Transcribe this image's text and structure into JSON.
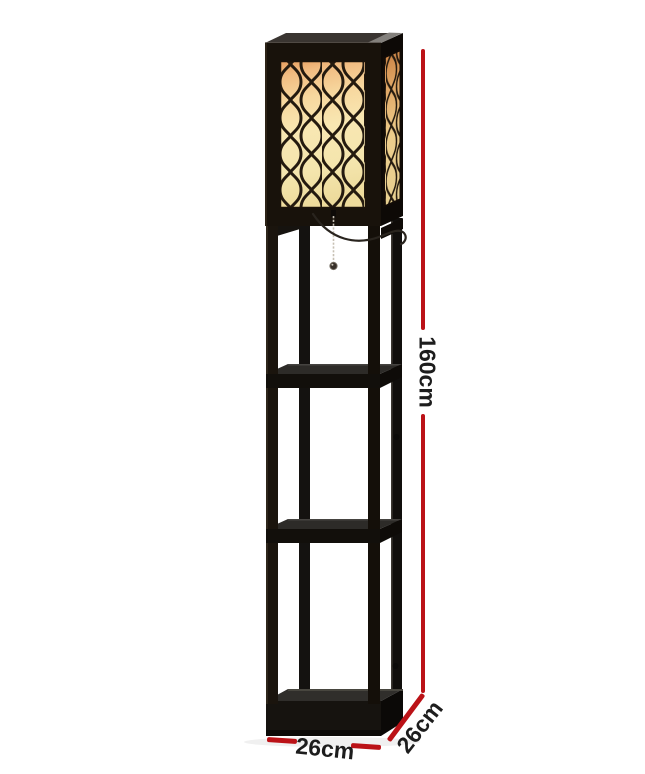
{
  "image": {
    "background": "#ffffff",
    "subject": "black etagere shelf floor lamp with glowing ogee lattice shade",
    "frame_color": "#17110b",
    "shade_glow_top": "#f0b57c",
    "shade_glow_bottom": "#efe0a2",
    "lattice_color": "#241a0f"
  },
  "annotations": {
    "accent_color": "#bb1217",
    "text_color": "#1d1d1d",
    "height": {
      "label": "160cm"
    },
    "width": {
      "label": "26cm"
    },
    "depth": {
      "label": "26cm"
    }
  }
}
